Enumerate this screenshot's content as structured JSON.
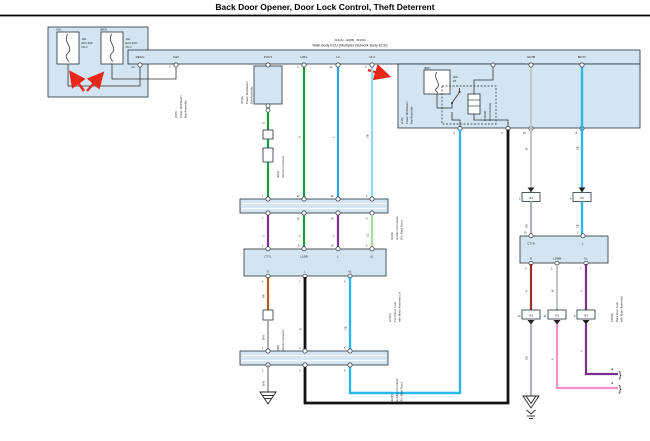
{
  "title": "Back Door Opener, Door Lock Control, Theft Deterrent",
  "colors": {
    "panel_blue": "#d3e5f1",
    "green": "#169a3e",
    "blue": "#2aa7df",
    "sky_blue": "#8ed9f2",
    "cyan": "#29b7ec",
    "purple": "#7b2f92",
    "light_green": "#a6d79c",
    "brown": "#b05a20",
    "dark_red": "#93301f",
    "pink": "#f392c2",
    "gray": "#b0b0b8",
    "black_wire": "#141414",
    "annotation_red": "#e82619"
  },
  "fuse_box": {
    "fuse1_tag": "(IG)",
    "fuse1_amp": "10A",
    "fuse1_name": "ECU-IGR",
    "fuse1_no": "NO.2",
    "fuse2_tag": "(BAT)",
    "fuse2_amp": "10A",
    "fuse2_name": "ECU-DCC",
    "fuse2_no": "NO.2",
    "assembly_code": "(F25)",
    "assembly_line1": "Power Distribution",
    "assembly_line2": "Box Assembly"
  },
  "main_ecu": {
    "code": "J14(A), J24(B), J31(M)",
    "name": "Main Body ECU (Multiplex Network Body ECU)",
    "pins": {
      "recu": "RECU",
      "igr": "IGR",
      "puct": "PUCT",
      "l5fl": "L5FL",
      "l2": "L2",
      "ul3": "UL3",
      "actb": "ACTB",
      "bcty": "BCTY"
    },
    "pin_nums": {
      "recu": "23",
      "igr": "7",
      "puct": "2",
      "l5fl": "4",
      "l2": "24",
      "ul3": "4",
      "actb": "12",
      "bcty": "9"
    }
  },
  "pdb_connector": {
    "code": "I15(A)",
    "line1": "Power Distribution",
    "line2": "Box Assembly"
  },
  "inline_connector": {
    "code": "I12(A)",
    "name": "Junction Connector"
  },
  "junction_bar1": {
    "code": "I10(A)",
    "line1": "Junction Connector",
    "line2": "(For Back Door)",
    "top_nums": [
      "7",
      "13",
      "14",
      "4"
    ],
    "bottom_nums": [
      "7",
      "13",
      "14",
      "4"
    ]
  },
  "lock_lh": {
    "code": "L07(C)",
    "line1": "Front Door Lock",
    "line2": "with Motor Assembly LH",
    "pin_ctyl": "CTYL",
    "pin_lsdb": "LSDB",
    "pin_l": "L",
    "pin_ul": "UL",
    "pin_e": "E",
    "pin_l2": "L",
    "pin_ul2": "UL",
    "top_nums": [
      "1",
      "8",
      "10",
      "5"
    ],
    "bottom_nums": [
      "4",
      "7",
      "9"
    ]
  },
  "junction_bar2": {
    "code": "I16(B)",
    "line1": "Junction Connector",
    "line2": "(For Back Door)",
    "top_nums": [
      "1",
      "3",
      "5"
    ],
    "bottom_nums": [
      "1",
      "3",
      "5"
    ]
  },
  "jc_brown": {
    "code": "I14(B)",
    "name": "Junction Connector"
  },
  "relay_box": {
    "fuse_tag": "(BAT)",
    "fuse_amp": "30A",
    "fuse_name": "P/I",
    "relay_line1": "D DOOR",
    "relay_line2": "UNLOCK Relay",
    "assembly_code": "(J15)",
    "assembly_line1": "Power Distribution",
    "assembly_line2": "Box Assembly",
    "pin_nums": [
      "3",
      "2",
      "10",
      "8"
    ]
  },
  "lock_back": {
    "code": "P05(B)",
    "line1": "Back Door Lock",
    "line2": "with Motor Assembly",
    "pin_ctyb": "CTYB",
    "pin_l": "L",
    "pin_e": "E",
    "pin_lswb": "LSWB",
    "pin_ul": "UL",
    "top_nums": [
      "10",
      "6"
    ],
    "bottom_nums": [
      "4",
      "1",
      "7"
    ]
  },
  "connectors": {
    "ik1_left": "IK1",
    "ik1_left_num": "1",
    "ik1_right": "IK1",
    "ik1_right_num": "9",
    "ik3_a": "IK3",
    "ik3_a_num": "12",
    "ik3_b": "IK3",
    "ik3_b_num": "11",
    "ik3_c": "IK3",
    "ik3_c_num": "5"
  },
  "wire_labels": {
    "g1": "G",
    "g2": "G",
    "l": "L",
    "sb_top": "SB",
    "v1": "V",
    "g3": "G",
    "v2": "V",
    "lg": "LG",
    "br": "BR",
    "wb1": "W-B",
    "wb2": "W-B",
    "b": "B",
    "sb_bottom": "SB",
    "w_top": "W",
    "gr_mid": "GR",
    "sb_r1": "SB",
    "sb_r2": "SB",
    "r": "R",
    "w2": "W",
    "v3": "V",
    "gr_low": "GR",
    "p": "P",
    "v4": "V"
  },
  "marks": {
    "brace": "}",
    "asterisk": "*"
  }
}
